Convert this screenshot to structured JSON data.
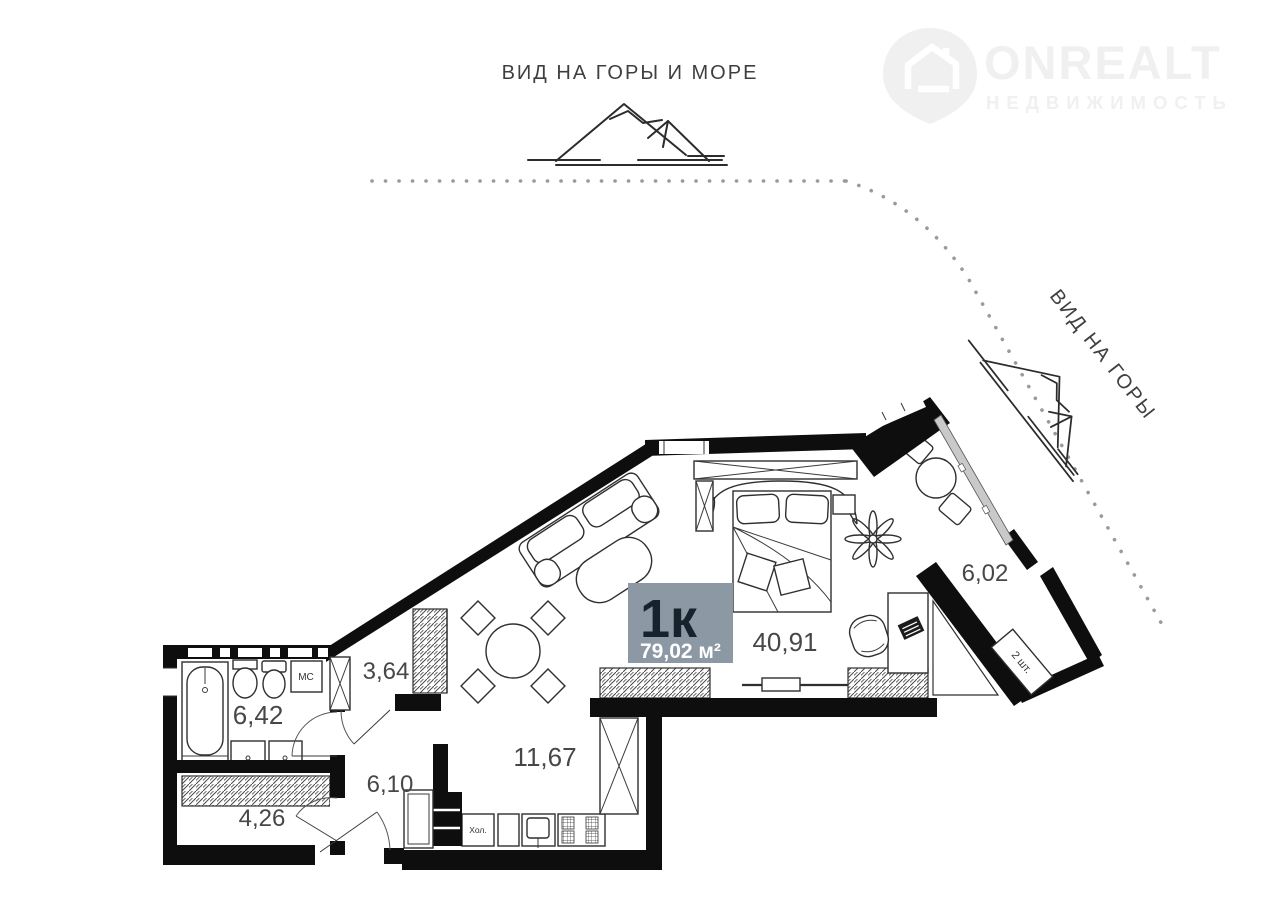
{
  "watermark": {
    "brand": "ONREALT",
    "subtitle": "НЕДВИЖИМОСТЬ"
  },
  "views": {
    "top_label": "ВИД НА ГОРЫ И МОРЕ",
    "side_label": "ВИД НА ГОРЫ"
  },
  "apartment": {
    "type": "1к",
    "area": "79,02 м²"
  },
  "rooms": {
    "bathroom": {
      "area": "6,42"
    },
    "storage": {
      "area": "4,26"
    },
    "hallway": {
      "area": "6,10"
    },
    "closet": {
      "area": "3,64"
    },
    "kitchen": {
      "area": "11,67"
    },
    "living": {
      "area": "40,91"
    },
    "balcony": {
      "area": "6,02"
    }
  },
  "annotations": {
    "washing_machine": "МС",
    "fridge": "Хол.",
    "ac_units": "2 шт."
  },
  "colors": {
    "area_badge_bg": "#8c99a4",
    "area_badge_type_text": "#16222c",
    "area_badge_area_text": "#ffffff",
    "walls": "#0e0e0e",
    "watermark": "#f1f0f1",
    "view_dots": "#9a9a9a"
  }
}
